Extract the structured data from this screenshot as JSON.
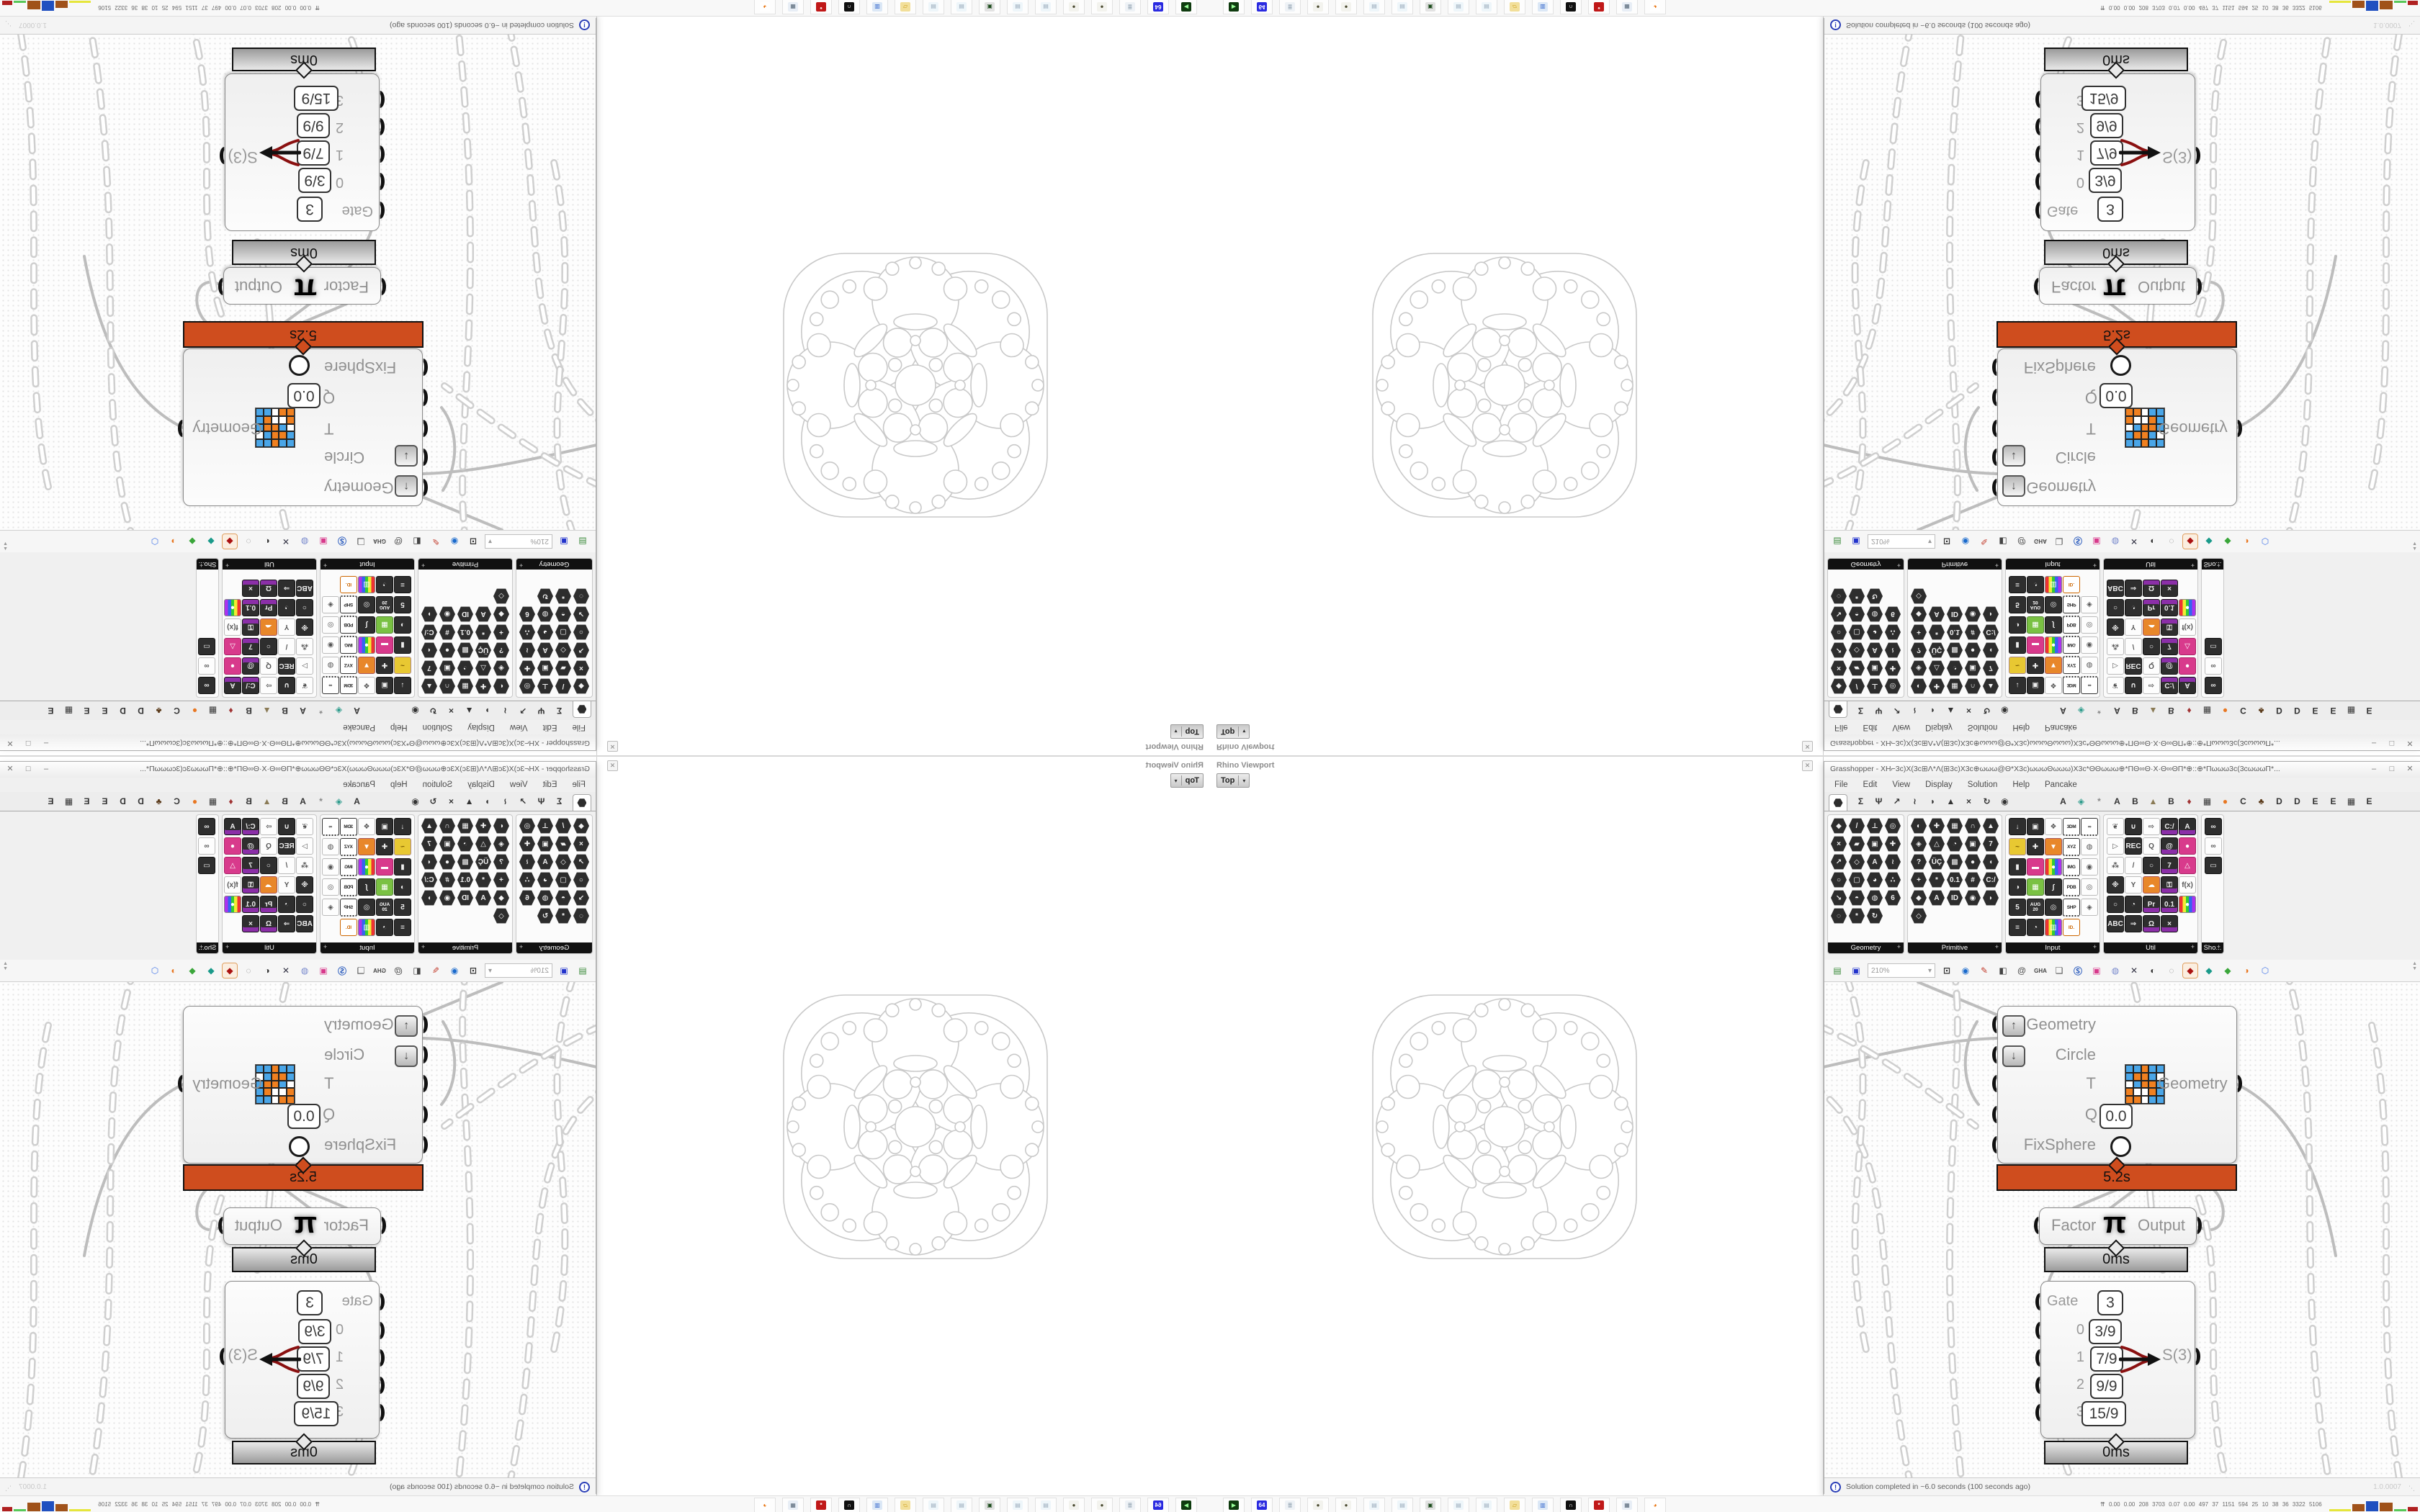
{
  "screen": {
    "rhino": {
      "panel_title": "Rhino Viewport",
      "close": "✕",
      "viewport_tab": "Top",
      "tab_arrow": "▾"
    },
    "gh": {
      "title": "Grasshopper - XH⌐3c)X(3c⊞Λ*Λ(⊞3c)X3c⊕ωωω@Θ*X3c)ωωωΘωωω)X3c*ΘΘωωω⊕*ΠΘ∞Θ·X·Θ∞ΘΠ*⊕::⊕*Πωωω3c(3cωωωΠ*...",
      "window_buttons": [
        "–",
        "□",
        "✕"
      ],
      "menus": [
        "File",
        "Edit",
        "View",
        "Display",
        "Solution",
        "Help",
        "Pancake"
      ],
      "tabs": [
        {
          "g": "HEX",
          "sel": true
        },
        {
          "g": "Σ"
        },
        {
          "g": "Ψ"
        },
        {
          "g": "↗"
        },
        {
          "g": "≀"
        },
        {
          "g": "◗"
        },
        {
          "g": "▲"
        },
        {
          "g": "×"
        },
        {
          "g": "↻"
        },
        {
          "g": "◉"
        },
        {
          "sp": true
        },
        {
          "g": "A"
        },
        {
          "g": "◈",
          "c": "#2a9a8a"
        },
        {
          "g": "*",
          "c": "#888"
        },
        {
          "g": "A"
        },
        {
          "g": "B"
        },
        {
          "g": "▲",
          "c": "#8a7a55"
        },
        {
          "g": "B"
        },
        {
          "g": "♦",
          "c": "#a03333"
        },
        {
          "g": "▦"
        },
        {
          "g": "●",
          "c": "#e87722"
        },
        {
          "g": "C"
        },
        {
          "g": "♣",
          "c": "#5a3a1a"
        },
        {
          "g": "D"
        },
        {
          "g": "D"
        },
        {
          "g": "E"
        },
        {
          "g": "E"
        },
        {
          "g": "▦"
        },
        {
          "g": "E"
        }
      ],
      "panel_plus": "+",
      "ribbon": [
        {
          "name": "Geometry",
          "cols": 4,
          "icons": [
            [
              "◆",
              "hx"
            ],
            [
              "/",
              "hx"
            ],
            [
              "⊥",
              "hx"
            ],
            [
              "◎",
              "hx"
            ],
            [
              "×",
              "hx"
            ],
            [
              "▰",
              "hx"
            ],
            [
              "▣",
              "hx"
            ],
            [
              "✚",
              "hx"
            ],
            [
              "↗",
              "hx"
            ],
            [
              "◇",
              "hx"
            ],
            [
              "A",
              "hx"
            ],
            [
              "≀",
              "hx"
            ],
            [
              "○",
              "hx"
            ],
            [
              "▢",
              "hx"
            ],
            [
              "◕",
              "hx"
            ],
            [
              "∴",
              "hx"
            ],
            [
              "↘",
              "hx"
            ],
            [
              "◓",
              "hx"
            ],
            [
              "◍",
              "hx"
            ],
            [
              "6",
              "hx"
            ],
            [
              "◌",
              "hx"
            ],
            [
              "*",
              "hx"
            ],
            [
              "↻",
              "hx"
            ]
          ]
        },
        {
          "name": "Primitive",
          "cols": 5,
          "icons": [
            [
              "◐",
              "hx"
            ],
            [
              "✚",
              "hx"
            ],
            [
              "▦",
              "hx"
            ],
            [
              "∩",
              "hx"
            ],
            [
              "▲",
              "hx"
            ],
            [
              "◈",
              "hx"
            ],
            [
              "△",
              "hx"
            ],
            [
              "◔",
              "hx"
            ],
            [
              "▣",
              "hx"
            ],
            [
              "7",
              "hx"
            ],
            [
              "?",
              "hx"
            ],
            [
              "ÜÇ",
              "hx"
            ],
            [
              "▩",
              "hx"
            ],
            [
              "●",
              "hx"
            ],
            [
              "◖",
              "hx"
            ],
            [
              "+",
              "hx"
            ],
            [
              "*",
              "hx"
            ],
            [
              "0.1",
              "hx"
            ],
            [
              "#",
              "hx"
            ],
            [
              "C:/",
              "hx"
            ],
            [
              "◆",
              "hx"
            ],
            [
              "A",
              "hx"
            ],
            [
              "ID",
              "hx"
            ],
            [
              "◉",
              "hx"
            ],
            [
              "◗",
              "hx"
            ],
            [
              "◇",
              "hx"
            ]
          ]
        },
        {
          "name": "Input",
          "cols": 5,
          "icons": [
            [
              "↓",
              "dk"
            ],
            [
              "▣",
              "dk"
            ],
            [
              "❖",
              "wh"
            ],
            [
              "3DM",
              "tag"
            ],
            [
              "∞",
              "tag"
            ],
            [
              "~",
              "yw"
            ],
            [
              "✚",
              "dk"
            ],
            [
              "▼",
              "or"
            ],
            [
              "XYZ",
              "tag"
            ],
            [
              "◍",
              "wh"
            ],
            [
              "▮",
              "dk"
            ],
            [
              "▬",
              "pk"
            ],
            [
              "●",
              "rb"
            ],
            [
              "IMG",
              "tag"
            ],
            [
              "◉",
              "wh"
            ],
            [
              "◑",
              "dk"
            ],
            [
              "▦",
              "gr"
            ],
            [
              "∫",
              "dk"
            ],
            [
              "PDB",
              "tag"
            ],
            [
              "◎",
              "wh"
            ],
            [
              "5",
              "dk"
            ],
            [
              "AUG 20",
              "date"
            ],
            [
              "◎",
              "dk"
            ],
            [
              "SHP",
              "tag"
            ],
            [
              "◈",
              "wh"
            ],
            [
              "≡",
              "dk"
            ],
            [
              "◔",
              "dk"
            ],
            [
              "▥",
              "rb"
            ],
            [
              "ID.",
              "id"
            ]
          ]
        },
        {
          "name": "Util",
          "cols": 5,
          "icons": [
            [
              "❦",
              "wh"
            ],
            [
              "∪",
              "dk"
            ],
            [
              "⇨",
              "wh"
            ],
            [
              "C:/",
              "pu"
            ],
            [
              "A",
              "pu"
            ],
            [
              "▷",
              "wh"
            ],
            [
              "REC",
              "dk"
            ],
            [
              "Q",
              "wh"
            ],
            [
              "@",
              "pu"
            ],
            [
              "●",
              "pk"
            ],
            [
              "⁂",
              "wh"
            ],
            [
              "/",
              "wh"
            ],
            [
              "○",
              "dk"
            ],
            [
              "7",
              "pu"
            ],
            [
              "△",
              "pk"
            ],
            [
              "※",
              "dk"
            ],
            [
              "Y",
              "wh"
            ],
            [
              "☁",
              "or"
            ],
            [
              "⚿",
              "pu"
            ],
            [
              "f(x)",
              "wh"
            ],
            [
              "○",
              "dk"
            ],
            [
              "◔",
              "dk"
            ],
            [
              "Pr",
              "pu"
            ],
            [
              "0.1",
              "pu"
            ],
            [
              "●",
              "rb"
            ],
            [
              "ABC",
              "dk"
            ],
            [
              "⇒",
              "dk"
            ],
            [
              "Ω",
              "pu"
            ],
            [
              "×",
              "pu"
            ]
          ]
        },
        {
          "name": "Sho...",
          "cols": 1,
          "icons": [
            [
              "∞",
              "dk"
            ],
            [
              "∞",
              "wh"
            ],
            [
              "▭",
              "dk"
            ]
          ]
        }
      ],
      "toolbar": {
        "zoom": "210%",
        "icons": [
          {
            "g": "▤",
            "c": "#3a8a3a",
            "name": "open-file-icon"
          },
          {
            "g": "▣",
            "c": "#2233cc",
            "name": "save-file-icon"
          },
          {
            "g": "⊡",
            "c": "#333",
            "name": "zoom-extents-icon"
          },
          {
            "g": "◉",
            "c": "#1a6acc",
            "name": "preview-eye-icon"
          },
          {
            "g": "✎",
            "c": "#c23a2a",
            "name": "sketch-icon"
          },
          {
            "g": "◧",
            "c": "#444",
            "name": "exoskeleton-icon"
          },
          {
            "g": "@",
            "c": "#555",
            "name": "mail-icon"
          },
          {
            "g": "GHA",
            "c": "#444",
            "name": "gha-icon"
          },
          {
            "g": "❏",
            "c": "#555",
            "name": "window-icon"
          },
          {
            "g": "Ⓢ",
            "c": "#2255bb",
            "name": "finder-icon"
          },
          {
            "g": "▣",
            "c": "#d83a8c",
            "name": "package-icon"
          },
          {
            "g": "◍",
            "c": "#7788cc",
            "name": "lightbulb-icon"
          },
          {
            "g": "✕",
            "c": "#334",
            "name": "wires-icon"
          },
          {
            "g": "◐",
            "c": "#333",
            "name": "preview-dark-icon"
          },
          {
            "g": "◌",
            "c": "#888",
            "name": "preview-wire-icon"
          },
          {
            "g": "◆",
            "c": "#aa1111",
            "name": "preview-shaded-icon",
            "sel": true
          },
          {
            "g": "◆",
            "c": "#1a9a8a",
            "name": "pin-teal-icon"
          },
          {
            "g": "◆",
            "c": "#3aa63a",
            "name": "pin-green-icon"
          },
          {
            "g": "◑",
            "c": "#e87722",
            "name": "ball-orange-icon"
          },
          {
            "g": "⬡",
            "c": "#4a7ae8",
            "name": "ball-blue-icon"
          }
        ],
        "dropdown_arrow": "▾",
        "scroll_arrows": "▲▼"
      },
      "canvas": {
        "fix_component": {
          "inputs": [
            "Geometry",
            "Circle",
            "T",
            "Q",
            "FixSphere"
          ],
          "graft_up": "↑",
          "graft_down": "↓",
          "q_value": "0.0",
          "output": "Geometry",
          "runtime": "5.2s"
        },
        "pi_component": {
          "input": "Factor",
          "symbol": "π",
          "output": "Output",
          "runtime": "0ms"
        },
        "gate_panel": {
          "rows": [
            {
              "label": "Gate",
              "value": "3"
            },
            {
              "label": "0",
              "value": "3/9"
            },
            {
              "label": "1",
              "value": "7/9"
            },
            {
              "label": "2",
              "value": "9/9"
            },
            {
              "label": "3",
              "value": "15/9"
            }
          ],
          "output": "S(3)",
          "runtime": "0ms"
        }
      },
      "status": {
        "icon": "!",
        "text": "Solution completed in ~6.0 seconds (100 seconds ago)",
        "version": "1.0.0007",
        "grip": "⋱"
      }
    },
    "taskbar": {
      "apps": [
        {
          "name": "emulator-icon",
          "bg": "#0f3b0f",
          "fg": "#9f9",
          "g": "▶"
        },
        {
          "name": "floppy-64-icon",
          "bg": "#2a2ae0",
          "fg": "#fff",
          "g": "64"
        },
        {
          "name": "document-icon",
          "bg": "#eef2f6",
          "fg": "#8899aa",
          "g": "≣"
        },
        {
          "name": "sphere-icon",
          "bg": "#f3f3ee",
          "fg": "#4a4a30",
          "g": "●"
        },
        {
          "name": "sphere-icon",
          "bg": "#f3f3ee",
          "fg": "#4a4a30",
          "g": "●"
        },
        {
          "name": "notepad-icon",
          "bg": "#eef6fa",
          "fg": "#99aabb",
          "g": "▤"
        },
        {
          "name": "notepad-icon",
          "bg": "#eef6fa",
          "fg": "#99aabb",
          "g": "▤"
        },
        {
          "name": "monitor-icon",
          "bg": "#e2e2e2",
          "fg": "#1a4a1a",
          "g": "▣"
        },
        {
          "name": "notepad-icon",
          "bg": "#eef6fa",
          "fg": "#99aabb",
          "g": "▤"
        },
        {
          "name": "notepad-icon",
          "bg": "#eef6fa",
          "fg": "#99aabb",
          "g": "▤"
        },
        {
          "name": "folder-icon",
          "bg": "#f2df9a",
          "fg": "#c89a10",
          "g": "▱"
        },
        {
          "name": "display-settings-icon",
          "bg": "#dce8f6",
          "fg": "#3366cc",
          "g": "▥"
        },
        {
          "name": "rhino-icon",
          "bg": "#111111",
          "fg": "#ffffff",
          "g": "∩"
        },
        {
          "name": "red-gear-icon",
          "bg": "#c01818",
          "fg": "#ffffff",
          "g": "*"
        },
        {
          "name": "calculator-icon",
          "bg": "#e8eef6",
          "fg": "#556677",
          "g": "▦"
        },
        {
          "name": "firefox-icon",
          "bg": "#ffffff",
          "fg": "#e8720c",
          "g": "◕"
        }
      ],
      "stats_icon": "⇈",
      "stats": "0.00 0.00 208 3703 0.07 0.00 497 37 1151 594 25 10 38 36 3322 5106",
      "bars": [
        {
          "c": "#e6e63c",
          "w": 30,
          "h": 3
        },
        {
          "c": "#a0521a",
          "w": 17,
          "h": 10
        },
        {
          "c": "#2050c0",
          "w": 17,
          "h": 14
        },
        {
          "c": "#a0521a",
          "w": 18,
          "h": 12
        },
        {
          "c": "#58c858",
          "w": 17,
          "h": 3
        },
        {
          "c": "#b02020",
          "w": 14,
          "h": 6
        }
      ]
    }
  }
}
